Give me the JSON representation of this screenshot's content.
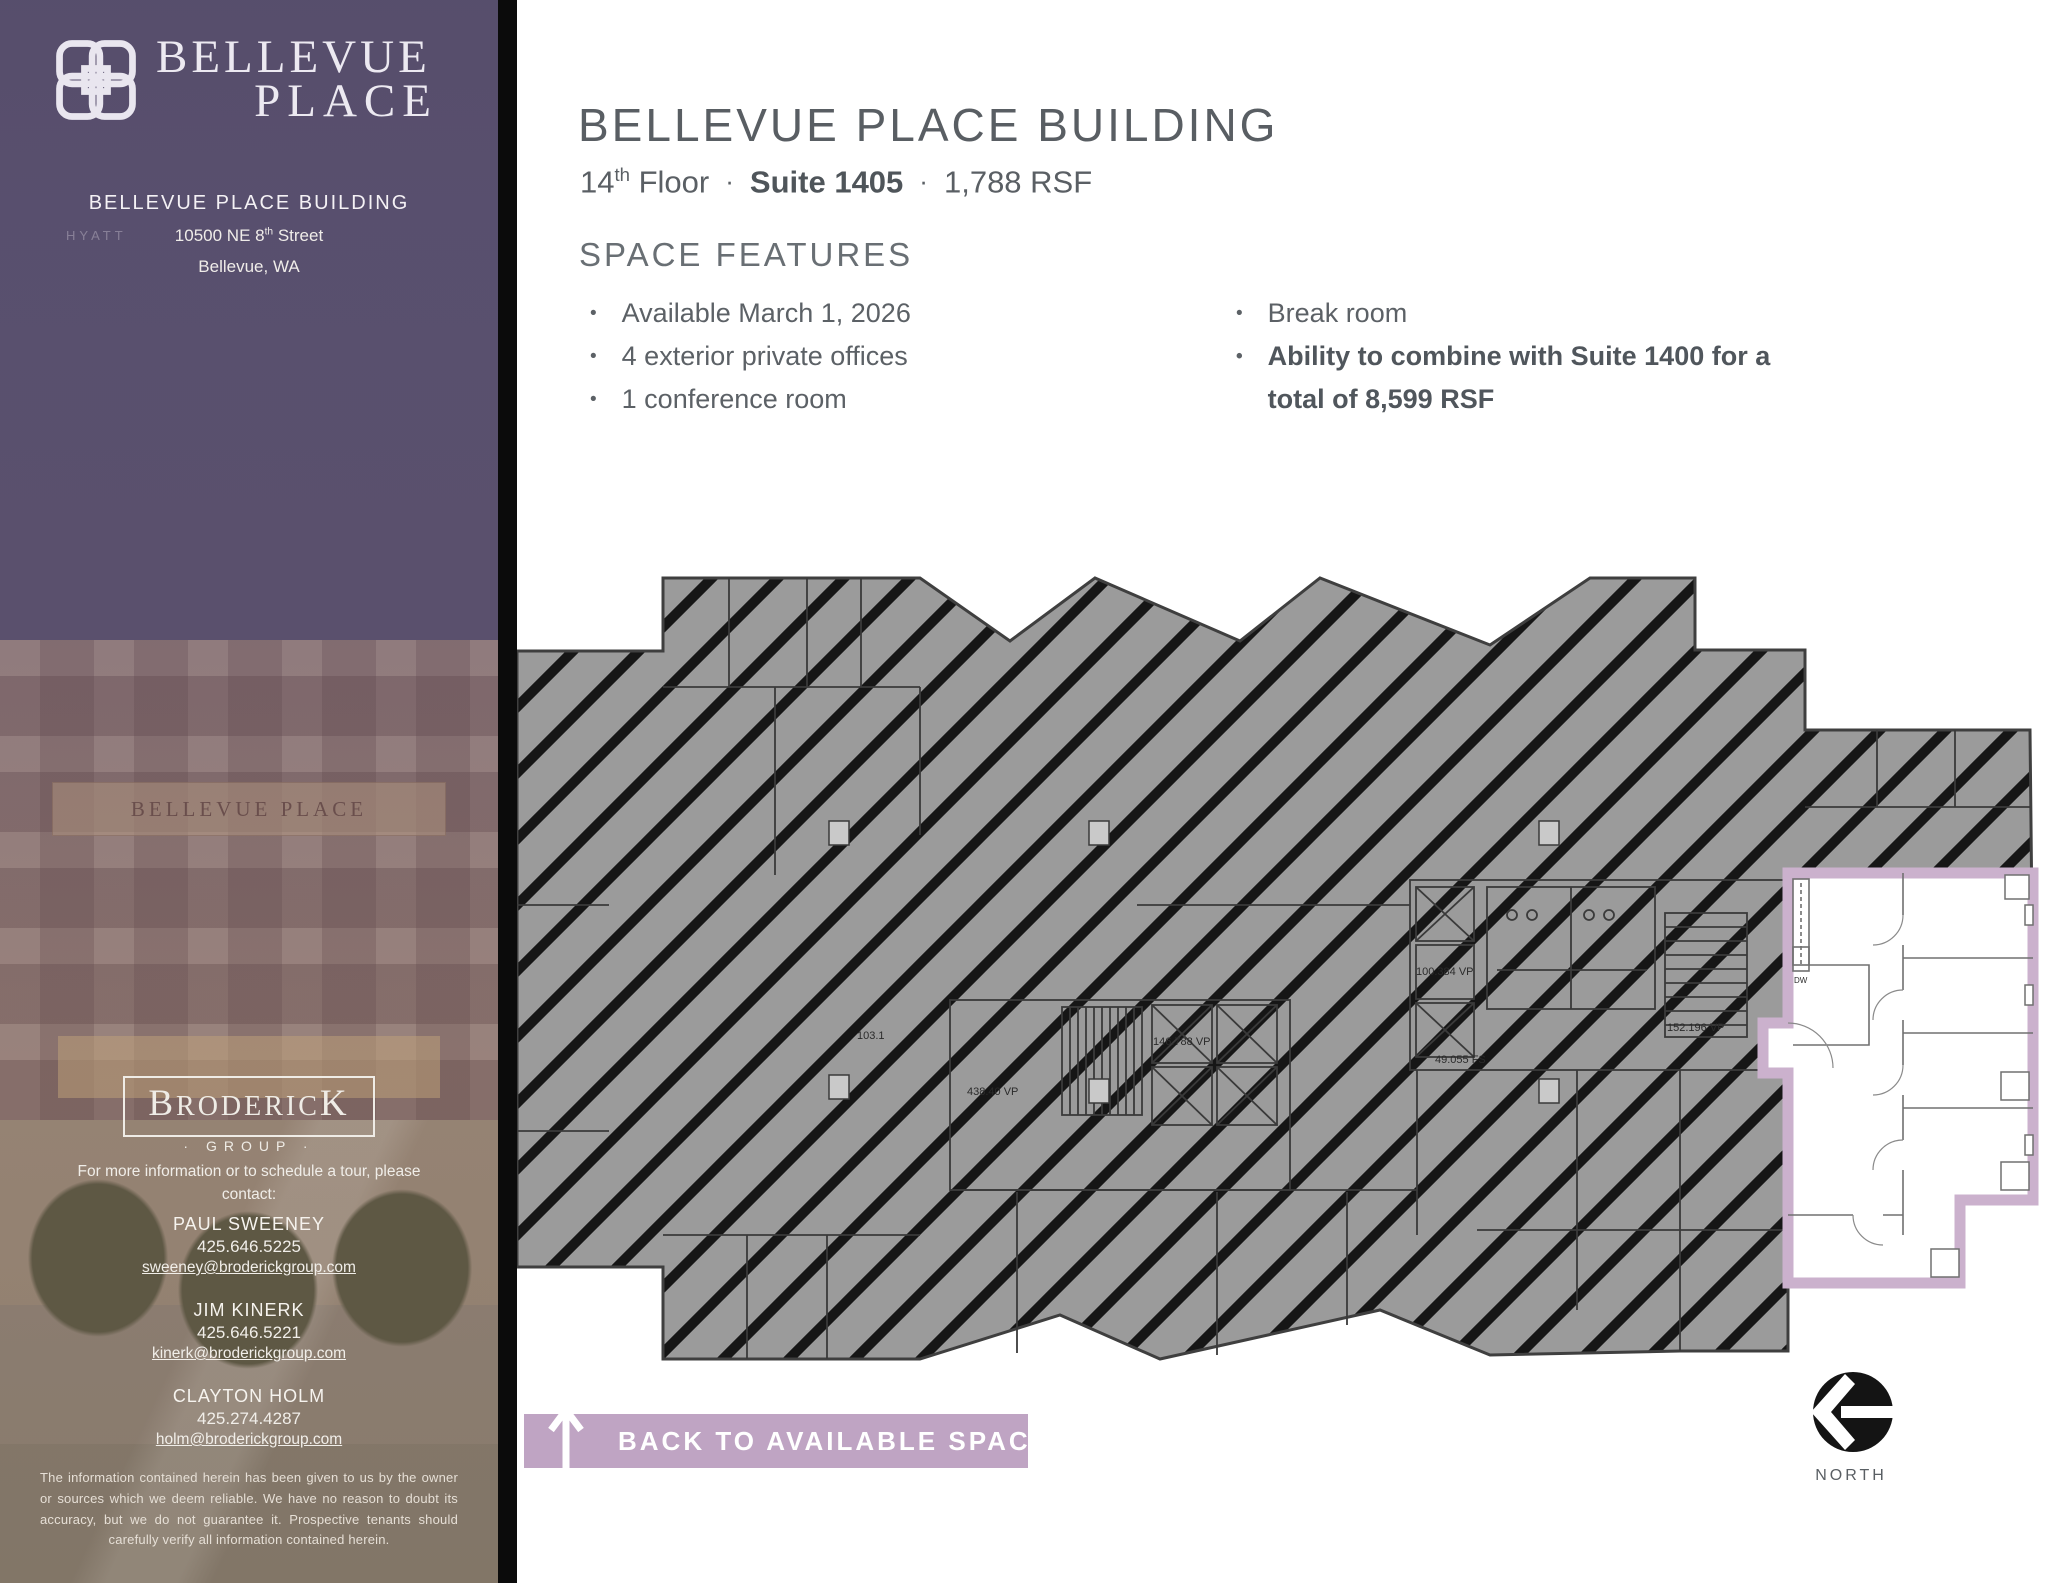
{
  "colors": {
    "accent_lavender": "#bfa4c3",
    "suite_outline": "#cbb1cd",
    "heading_gray": "#595e63",
    "plan_gray": "#9b9b9b",
    "sidebar_purple": "#5b5271"
  },
  "sidebar": {
    "logo": {
      "line1": "BELLEVUE",
      "line2": "PLACE"
    },
    "building_name": "BELLEVUE PLACE BUILDING",
    "address": {
      "line1_main": "10500 NE 8",
      "line1_sup": "th",
      "line1_rest": " Street",
      "line2": "Bellevue, WA"
    },
    "photo": {
      "hyatt_sign": "HYATT",
      "facade_sign": "BELLEVUE PLACE"
    },
    "broker": {
      "cap1": "B",
      "mid": "RODERIC",
      "cap2": "K",
      "subtitle": "· GROUP ·"
    },
    "contact_intro_line1": "For more information or to schedule a tour, please",
    "contact_intro_line2": "contact:",
    "contacts": [
      {
        "name": "PAUL SWEENEY",
        "phone": "425.646.5225",
        "email": "sweeney@broderickgroup.com"
      },
      {
        "name": "JIM KINERK",
        "phone": "425.646.5221",
        "email": "kinerk@broderickgroup.com"
      },
      {
        "name": "CLAYTON HOLM",
        "phone": "425.274.4287",
        "email": "holm@broderickgroup.com"
      }
    ],
    "disclaimer": "The information contained herein has been given to us by the owner or sources which we deem reliable. We have no reason to doubt its accuracy, but we do not guarantee it. Prospective tenants should carefully verify all information contained herein."
  },
  "main": {
    "title": "BELLEVUE PLACE BUILDING",
    "subtitle": {
      "floor_num": "14",
      "floor_sup": "th",
      "floor_word": " Floor",
      "sep1": "·",
      "suite": "Suite 1405",
      "sep2": "·",
      "rsf": "1,788 RSF"
    },
    "features": {
      "heading": "SPACE FEATURES",
      "left": [
        "Available March 1, 2026",
        "4 exterior private offices",
        "1 conference room"
      ],
      "right_normal": "Break room",
      "right_bold": "Ability to combine with Suite 1400 for a total of 8,599 RSF"
    },
    "back_button": {
      "label": "BACK TO AVAILABLE SPACE"
    },
    "north_label": "NORTH",
    "floor_plan": {
      "labels": {
        "l1": "103.1",
        "l2": "438.40 VP",
        "l3": "146.788 VP",
        "l4": "100.384 VP",
        "l5": "49.055 FS",
        "l6": "152.196 VP",
        "dw": "DW"
      }
    }
  }
}
